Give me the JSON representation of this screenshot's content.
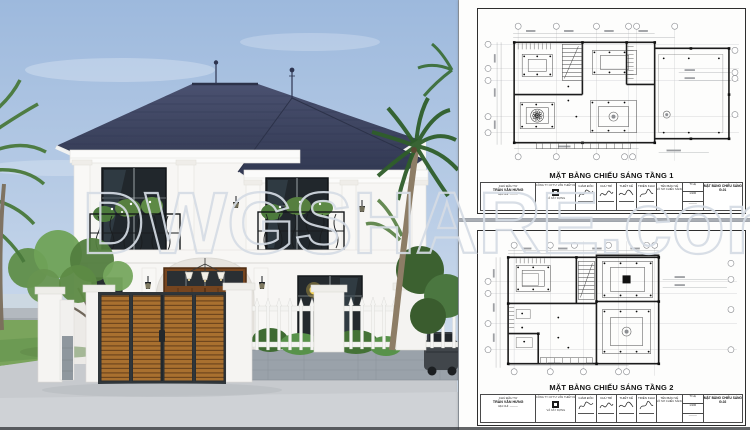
{
  "watermark": {
    "text": "DWGSHARE.com"
  },
  "render": {
    "colors": {
      "sky_top": "#9db9dd",
      "sky_bottom": "#dbe5f0",
      "roof": "#3f4663",
      "roof_ridge": "#2c3249",
      "wall": "#f7f6f4",
      "window_glass": "#21272c",
      "door_wood": "#76451f",
      "gate_wood": "#a9702f",
      "gate_frame": "#30363a",
      "fence_white": "#f5f5f3",
      "fence_base": "#9aa2aa",
      "driveway": "#c7cace",
      "grass": "#7aa45c",
      "foliage": "#5f8e49",
      "palm_frond": "#2f5e2a",
      "car": "#41464b",
      "lamp_glow": "#ffd84e"
    }
  },
  "sheets": [
    {
      "title": "MẶT BẰNG CHIẾU SÁNG TẦNG 1",
      "code": "Đ-01"
    },
    {
      "title": "MẶT BẰNG CHIẾU SÁNG TẦNG 2",
      "code": "Đ-02"
    }
  ],
  "title_block": {
    "owner_label": "CHỦ ĐẦU TƯ",
    "owner_name": "TRẦN VĂN HƯNG",
    "owner_sub": "ĐỊA CHỈ: ———",
    "company_line1": "CÔNG TY CP TƯ VẤN THIẾT KẾ",
    "company_line2": "VÀ XÂY DỰNG",
    "sig_cols": [
      {
        "label": "GIÁM ĐỐC"
      },
      {
        "label": "CHỦ TRÌ"
      },
      {
        "label": "THIẾT KẾ"
      },
      {
        "label": "TRIỂN KHAI"
      }
    ],
    "drawing_label": "TÊN BẢN VẼ",
    "drawing_name": "HỒ SƠ CHIẾU SÁNG",
    "scale_label": "TỈ LỆ",
    "scale_value": "1/100",
    "date_row": "———",
    "sheet_label": "MẶT BẰNG CHIẾU SÁNG"
  }
}
